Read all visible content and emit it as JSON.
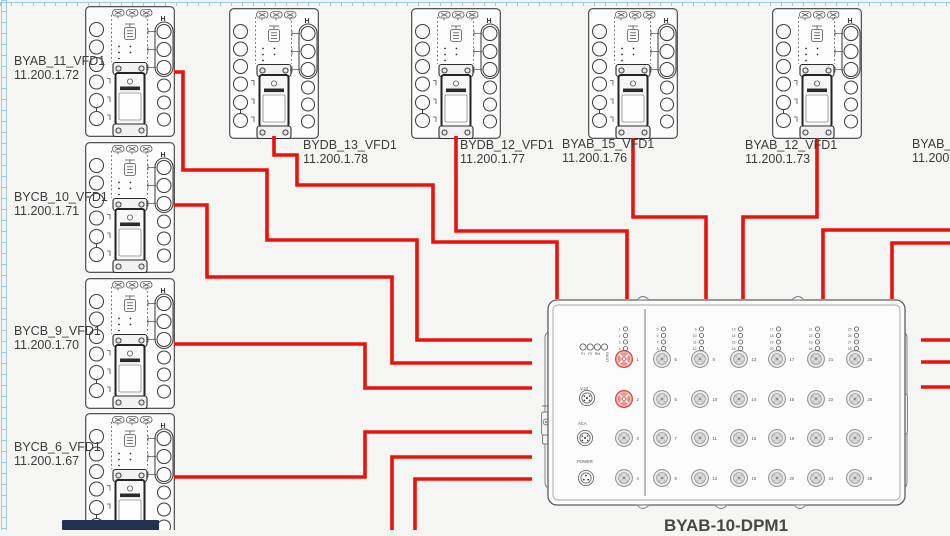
{
  "app": {
    "background": "#f5f5f4",
    "ruler_color": "#8cc6e0"
  },
  "colors": {
    "wire": "#e81309",
    "device_outline": "#3f3f3f",
    "label_text": "#3c3c3c",
    "port_highlight_fill": "#f3b7b1",
    "port_highlight_stroke": "#d8453c"
  },
  "vfd_marking": "H",
  "devices": {
    "left_column": [
      {
        "name": "BYAB_11_VFD1",
        "ip": "11.200.1.72"
      },
      {
        "name": "BYCB_10_VFD1",
        "ip": "11.200.1.71"
      },
      {
        "name": "BYCB_9_VFD1",
        "ip": "11.200.1.70"
      },
      {
        "name": "BYCB_6_VFD1",
        "ip": "11.200.1.67"
      }
    ],
    "top_row": [
      {
        "name": "BYDB_13_VFD1",
        "ip": "11.200.1.78"
      },
      {
        "name": "BYDB_12_VFD1",
        "ip": "11.200.1.77"
      },
      {
        "name": "BYAB_15_VFD1",
        "ip": "11.200.1.76"
      },
      {
        "name": "BYAB_12_VFD1",
        "ip": "11.200.1.73"
      },
      {
        "name": "BYAB_13",
        "ip": "11.200.1",
        "note": "clipped at right edge"
      }
    ],
    "dpm": {
      "name": "BYAB-10-DPM1",
      "status_leds": [
        "P1",
        "P2",
        "RM",
        "FAULT"
      ],
      "connector_labels": [
        "V.24",
        "ACA",
        "POWER"
      ],
      "port_count": 28,
      "highlighted_ports": [
        1,
        2
      ]
    }
  },
  "connections": [
    {
      "from": "BYAB_11_VFD1",
      "to": "BYAB-10-DPM1",
      "enters": "left"
    },
    {
      "from": "BYCB_10_VFD1",
      "to": "BYAB-10-DPM1",
      "enters": "left"
    },
    {
      "from": "BYCB_9_VFD1",
      "to": "BYAB-10-DPM1",
      "enters": "left"
    },
    {
      "from": "BYCB_6_VFD1",
      "to": "BYAB-10-DPM1",
      "enters": "left"
    },
    {
      "from": "off-screen-bottom",
      "to": "BYAB-10-DPM1",
      "enters": "left"
    },
    {
      "from": "off-screen-bottom",
      "to": "BYAB-10-DPM1",
      "enters": "left"
    },
    {
      "from": "BYDB_13_VFD1",
      "to": "BYAB-10-DPM1",
      "enters": "top"
    },
    {
      "from": "BYDB_12_VFD1",
      "to": "BYAB-10-DPM1",
      "enters": "top"
    },
    {
      "from": "BYAB_15_VFD1",
      "to": "BYAB-10-DPM1",
      "enters": "top"
    },
    {
      "from": "BYAB_12_VFD1",
      "to": "BYAB-10-DPM1",
      "enters": "top"
    },
    {
      "from": "off-screen-right",
      "to": "BYAB-10-DPM1",
      "enters": "top"
    },
    {
      "from": "off-screen-right",
      "to": "BYAB-10-DPM1",
      "enters": "top"
    },
    {
      "from": "off-screen-right",
      "to": "off-screen-right",
      "enters": "stub"
    },
    {
      "from": "off-screen-right",
      "to": "off-screen-right",
      "enters": "stub"
    },
    {
      "from": "off-screen-right",
      "to": "off-screen-right",
      "enters": "stub"
    }
  ]
}
